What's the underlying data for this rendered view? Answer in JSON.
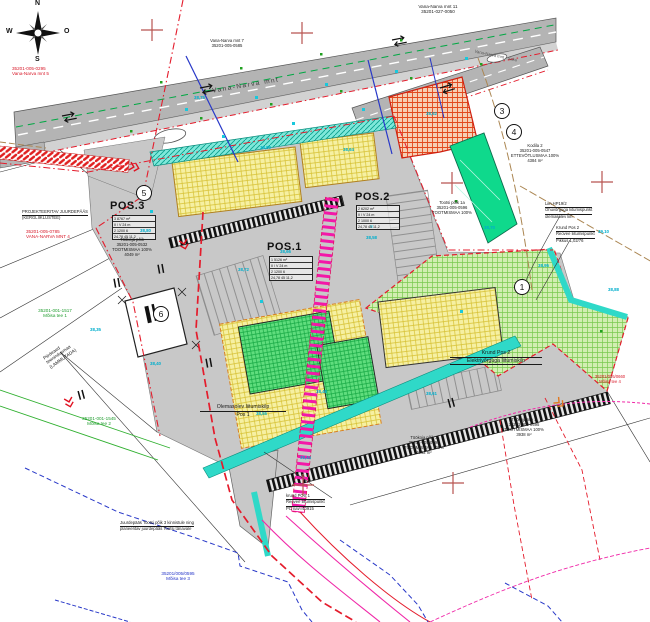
{
  "compass": {
    "n": "N",
    "e": "O",
    "s": "S",
    "w": "W"
  },
  "circles": {
    "c1": "1",
    "c3": "3",
    "c4": "4",
    "c5": "5",
    "c6": "6"
  },
  "pos_tables": {
    "pos3": {
      "title": "POS.3",
      "rows": [
        "3   8767 m²",
        "II / V   24 m",
        "2   1200   6",
        "24,78  45  11,2"
      ]
    },
    "pos1": {
      "title": "POS.1",
      "rows": [
        "1   5126 m²",
        "II / V   24 m",
        "2   1200   6",
        "24,78  45  11,2"
      ]
    },
    "pos2": {
      "title": "POS.2",
      "rows": [
        "2   6202 m²",
        "II / V   24 m",
        "2   1000   6",
        "24,78  45  11,2"
      ]
    }
  },
  "labels": {
    "vn5": {
      "l1": "35201-005-0295",
      "l2": "Vana-Narva mnt 5"
    },
    "vn11": {
      "l1": "Vana-Narva mnt 11",
      "l2": "35201-027-0050"
    },
    "vn7": {
      "l1": "Vana-Narva mnt 7",
      "l2": "35201-005-0585"
    },
    "roadmain": {
      "l1": "Vana-Narva mnt"
    },
    "roadbranch": {
      "l1": "Vana-Narva mnt - Saku"
    },
    "projjd": {
      "l1": "PROJEKTEERITAV JUURDEPÄÄS",
      "l2": "(KERGLIIKLUSTEE)"
    },
    "vn4": {
      "l1": "35201-005-0785",
      "l2": "VANA-NARVA MNT 4"
    },
    "moisa1": {
      "l1": "35201-001-1517",
      "l2": "Mõisa tee 1"
    },
    "piirdeaed": {
      "l1": "Piirdeaed",
      "l2": "teenindusmaa",
      "l3": "(LAMMUTADA)"
    },
    "moisa2": {
      "l1": "35201-001-1545",
      "l2": "Mõisa tee 2"
    },
    "tookoja": {
      "l1": "Töökoja põik",
      "l2": "35201-005-0532",
      "l3": "TOOTMISMAA 100%",
      "l4": "4049 m²"
    },
    "olem": {
      "l1": "Olemasolev liitumiskilp",
      "l2": "Pos 1"
    },
    "krund2": {
      "l1": "Krund Pos 2",
      "l2": "Elektrivõrguga liitumiskilp"
    },
    "kodila": {
      "l1": "Kodila 2",
      "l2": "35201-005-0547",
      "l3": "ETTEVÕTLUSMAA 100%",
      "l4": "4384 m²"
    },
    "liin": {
      "l1": "Liin HP19/2",
      "l2": "Õhuvõrguga liitumispunkt",
      "l3": "olemasolev liin"
    },
    "reovee2": {
      "l1": "Krund Pos 2",
      "l2": "Reovee liitumispunkt",
      "l3": "Pikkus 1,02/76"
    },
    "tootsi": {
      "l1": "Tootsi põik 1a",
      "l2": "35201-005-0596",
      "l3": "TOOTMISMAA 100%"
    },
    "tookoja3": {
      "l1": "Töökoja tee 3",
      "l2": "35201-005-0595",
      "l3": "TOOTMISMAA 100%",
      "l4": "3938 m²"
    },
    "tkpoik3": {
      "l1": "Töökoja põik 3",
      "l2": "35201-005-0594",
      "l3": "TOOTMISMAA 100%",
      "l4": "4092 m²"
    },
    "krund1": {
      "l1": "krund POS 1",
      "l2": "Reovee liitumispunkt",
      "l3": "PC nav=40915"
    },
    "juurdepaas": {
      "l1": "Juurdepääs Tootsi põik 3 kinnistule ning",
      "l2": "planeeritav juurdepääs Tootsi tänavale"
    },
    "moisa3": {
      "l1": "35201/005/0595",
      "l2": "Mõisa tee 3"
    },
    "moisa4": {
      "l1": "35201/005/0660",
      "l2": "Mõisa tee 4"
    }
  },
  "elevations": [
    {
      "t": "38,75",
      "x": 194,
      "y": 95
    },
    {
      "t": "38,90",
      "x": 260,
      "y": 145
    },
    {
      "t": "38,64",
      "x": 343,
      "y": 147
    },
    {
      "t": "38,52",
      "x": 426,
      "y": 111
    },
    {
      "t": "38,70",
      "x": 484,
      "y": 225
    },
    {
      "t": "38,95",
      "x": 538,
      "y": 263
    },
    {
      "t": "39,10",
      "x": 598,
      "y": 229
    },
    {
      "t": "38,58",
      "x": 366,
      "y": 235
    },
    {
      "t": "38,66",
      "x": 280,
      "y": 249
    },
    {
      "t": "38,48",
      "x": 316,
      "y": 389
    },
    {
      "t": "38,55",
      "x": 256,
      "y": 411
    },
    {
      "t": "38,40",
      "x": 150,
      "y": 361
    },
    {
      "t": "38,35",
      "x": 90,
      "y": 327
    },
    {
      "t": "38,61",
      "x": 426,
      "y": 391
    },
    {
      "t": "38,88",
      "x": 608,
      "y": 287
    },
    {
      "t": "38,72",
      "x": 238,
      "y": 267
    },
    {
      "t": "38,80",
      "x": 140,
      "y": 228
    },
    {
      "t": "38,44",
      "x": 300,
      "y": 455
    }
  ],
  "colors": {
    "road": "#b4b4b4",
    "site": "#c8c8c8",
    "yellow": "#f6f0a2",
    "green_parcel": "#d2eeb2",
    "bright_green": "#5fdd7d",
    "spring_green": "#0fd98c",
    "orange": "#e2491d",
    "teal": "#2fd9c8",
    "magenta": "#f318a8",
    "red_line": "#e41c2c",
    "blue_line": "#2838c8",
    "cyan_text": "#00aecc"
  }
}
